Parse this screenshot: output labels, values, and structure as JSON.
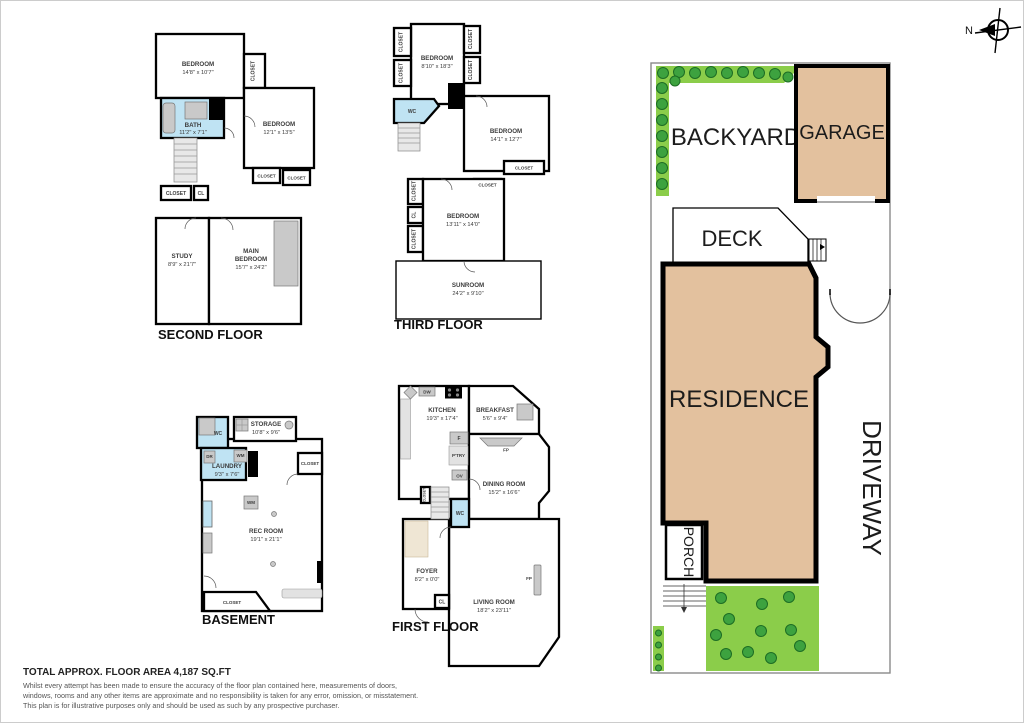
{
  "labels": {
    "closet": "CLOSET",
    "cl": "CL",
    "wc": "WC",
    "wm": "WM",
    "dr": "DR",
    "dw": "DW",
    "f": "F",
    "ov": "OV",
    "fp": "FP",
    "ptry": "P'TRY"
  },
  "floors": {
    "second": {
      "title": "SECOND FLOOR",
      "rooms": {
        "bedroom1": {
          "name": "BEDROOM",
          "dims": "14'8\" x 10'7\""
        },
        "bedroom2": {
          "name": "BEDROOM",
          "dims": "12'1\" x 13'5\""
        },
        "bath": {
          "name": "BATH",
          "dims": "11'2\" x 7'1\""
        },
        "study": {
          "name": "STUDY",
          "dims": "8'9\" x 21'7\""
        },
        "main_bedroom": {
          "line1": "MAIN",
          "line2": "BEDROOM",
          "dims": "15'7\" x 24'2\""
        }
      }
    },
    "third": {
      "title": "THIRD FLOOR",
      "rooms": {
        "bedroom1": {
          "name": "BEDROOM",
          "dims": "8'10\" x 18'3\""
        },
        "bedroom2": {
          "name": "BEDROOM",
          "dims": "14'1\" x 12'7\""
        },
        "bedroom3": {
          "name": "BEDROOM",
          "dims": "13'11\" x 14'0\""
        },
        "sunroom": {
          "name": "SUNROOM",
          "dims": "24'2\" x 9'10\""
        }
      }
    },
    "basement": {
      "title": "BASEMENT",
      "rooms": {
        "storage": {
          "name": "STORAGE",
          "dims": "10'8\" x 9'6\""
        },
        "laundry": {
          "name": "LAUNDRY",
          "dims": "9'3\" x 7'6\""
        },
        "rec_room": {
          "name": "REC ROOM",
          "dims": "19'1\" x 21'1\""
        }
      }
    },
    "first": {
      "title": "FIRST FLOOR",
      "rooms": {
        "kitchen": {
          "name": "KITCHEN",
          "dims": "19'3\" x 17'4\""
        },
        "breakfast": {
          "name": "BREAKFAST",
          "dims": "5'6\" x 9'4\""
        },
        "dining": {
          "name": "DINING ROOM",
          "dims": "15'2\" x 16'6\""
        },
        "foyer": {
          "name": "FOYER",
          "dims": "8'2\" x 0'0\""
        },
        "living": {
          "name": "LIVING ROOM",
          "dims": "18'2\" x 23'11\""
        }
      }
    }
  },
  "site_plan": {
    "backyard": "BACKYARD",
    "garage": "GARAGE",
    "deck": "DECK",
    "residence": "RESIDENCE",
    "porch": "PORCH",
    "driveway": "DRIVEWAY",
    "colors": {
      "building": "#e3c19e",
      "grass": "#8bcd4a",
      "tree": "#3da23f",
      "wet_room": "#bfe3f3",
      "wall": "#000000"
    }
  },
  "compass": {
    "north": "N"
  },
  "footer": {
    "title": "TOTAL APPROX. FLOOR AREA 4,187 SQ.FT",
    "line1": "Whilst every attempt has been made to ensure the accuracy of the floor plan contained here, measurements of doors,",
    "line2": "windows, rooms and any other items are approximate and no responsibility is taken for any error, omission, or misstatement.",
    "line3": "This plan is for illustrative purposes only and should be used as such by any prospective purchaser."
  }
}
